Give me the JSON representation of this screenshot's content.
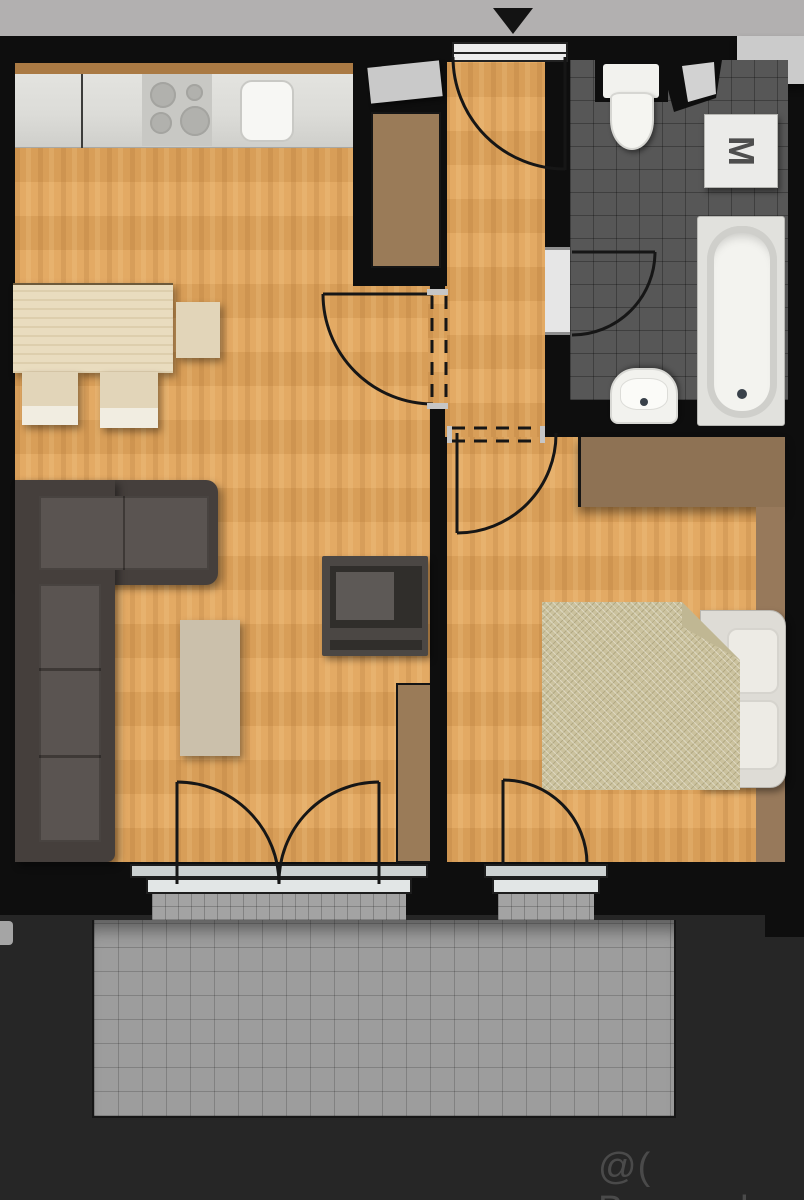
{
  "title": "apartment-floor-plan",
  "watermark": {
    "text": "@( Bazos.sk"
  },
  "labels": {
    "washing_machine": "M"
  },
  "palette": {
    "bg_dark": "#262626",
    "band_gray": "#b2b0b0",
    "wall": "#0e0e0e",
    "wood": "#e2a55c",
    "wood_dark": "#aa7a44",
    "counter": "#dcdcd8",
    "appliance_white": "#f2f2ee",
    "tile_dark": "#575757",
    "tile_light": "#9d9d9d",
    "furniture_brown": "#9a7b58",
    "wardrobe_brown": "#8e7254",
    "sofa_dark": "#453f3c",
    "sofa_cushion": "#5a5451",
    "table_beige": "#e9dcbf",
    "blanket": "#cbc29e",
    "watermark": "#4f4f4f"
  },
  "icons": {
    "north_arrow": "down-triangle",
    "stove": "four-burner-cooktop",
    "sink_kitchen": "rounded-square-basin",
    "toilet": "tank-and-bowl",
    "washing_machine": "square-with-M",
    "bathtub": "oval-tub",
    "bathroom_sink": "half-oval-basin",
    "bed": "double-bed-with-folded-blanket",
    "sofa": "l-shaped-corner-sofa",
    "tv": "tv-on-media-unit"
  },
  "rooms": [
    {
      "name": "kitchen-living-room",
      "furniture": [
        "kitchen-counter",
        "stove",
        "kitchen-sink",
        "dining-table",
        "chairs",
        "corner-sofa",
        "coffee-table",
        "tv-unit",
        "wall-cabinet"
      ]
    },
    {
      "name": "entry-hall",
      "furniture": [
        "hall-closet",
        "hall-shelf"
      ]
    },
    {
      "name": "bathroom",
      "furniture": [
        "toilet",
        "washing-machine",
        "bathtub",
        "washbasin"
      ]
    },
    {
      "name": "bedroom",
      "furniture": [
        "wardrobe",
        "side-wardrobe",
        "double-bed"
      ]
    },
    {
      "name": "balcony",
      "furniture": []
    }
  ]
}
